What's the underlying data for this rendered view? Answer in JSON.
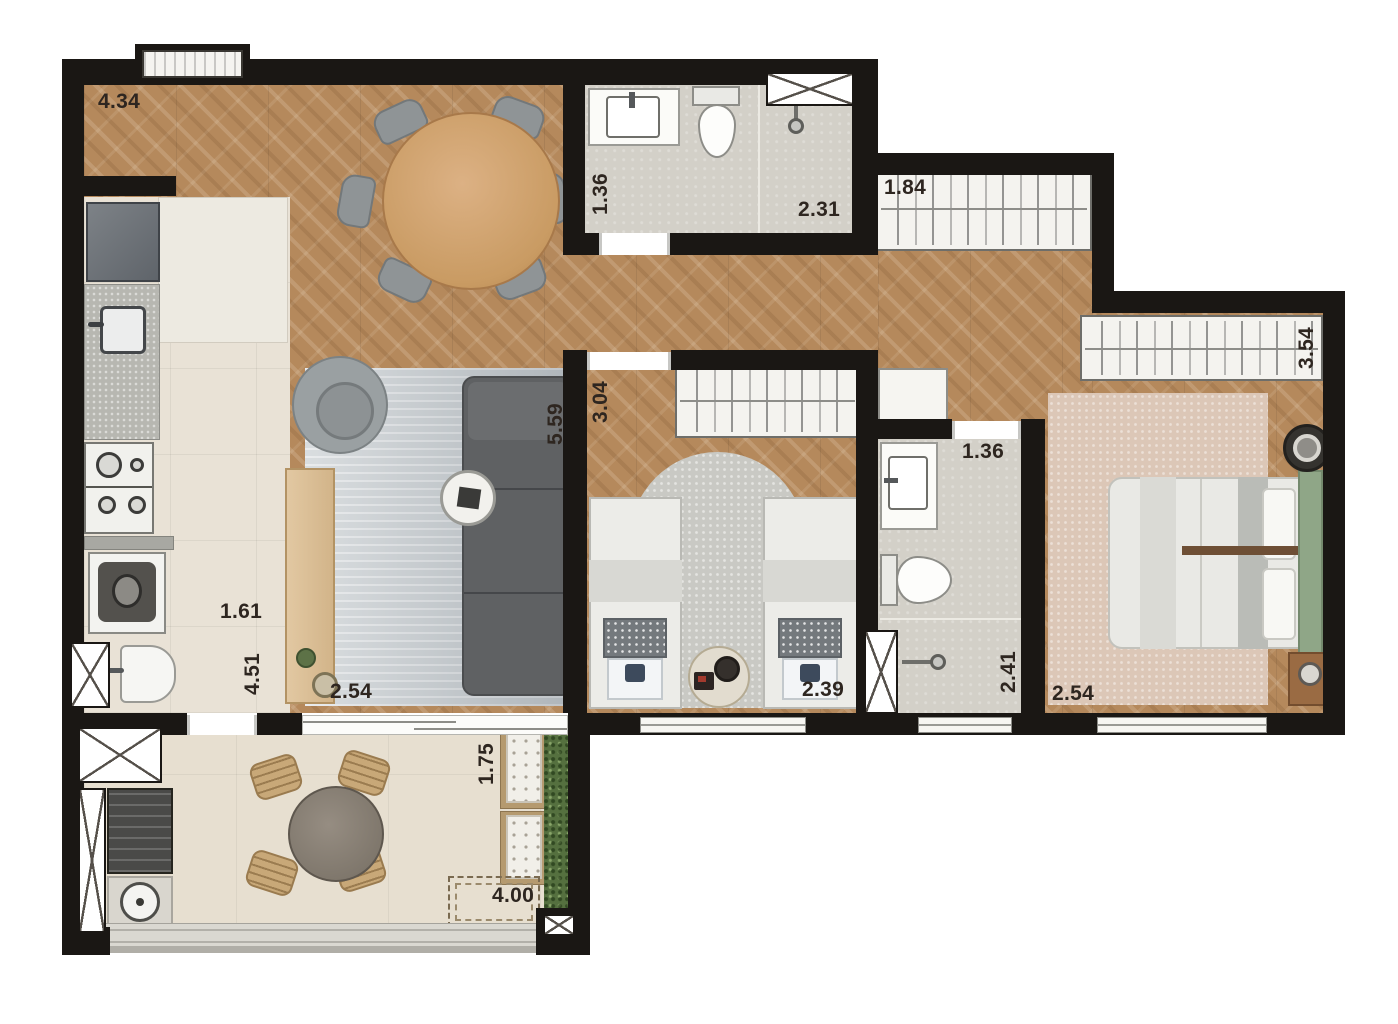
{
  "dimensions": {
    "living_top": "4.34",
    "bath1_width": "1.36",
    "bath1_length": "2.31",
    "hall_closet": "1.84",
    "master_closet": "3.54",
    "bedroom2_width": "3.04",
    "living_length": "5.59",
    "bath2_width": "1.36",
    "kitchen_width": "1.61",
    "kitchen_length": "4.51",
    "living_width": "2.54",
    "bedroom2_length": "2.39",
    "bath2_length": "2.41",
    "master_width": "2.54",
    "balcony_depth": "1.75",
    "balcony_length": "4.00"
  },
  "colors": {
    "wall": "#1a1714",
    "wood_floor": "#b5895c",
    "kitchen_tile": "#e9e2d6",
    "bath_tile": "#d3d0c8",
    "balcony_tile": "#e7dfd0",
    "headboard_green": "#8fa687",
    "hedge_green": "#55703f",
    "sofa_gray": "#5f6163",
    "label_text": "#2e2620"
  }
}
